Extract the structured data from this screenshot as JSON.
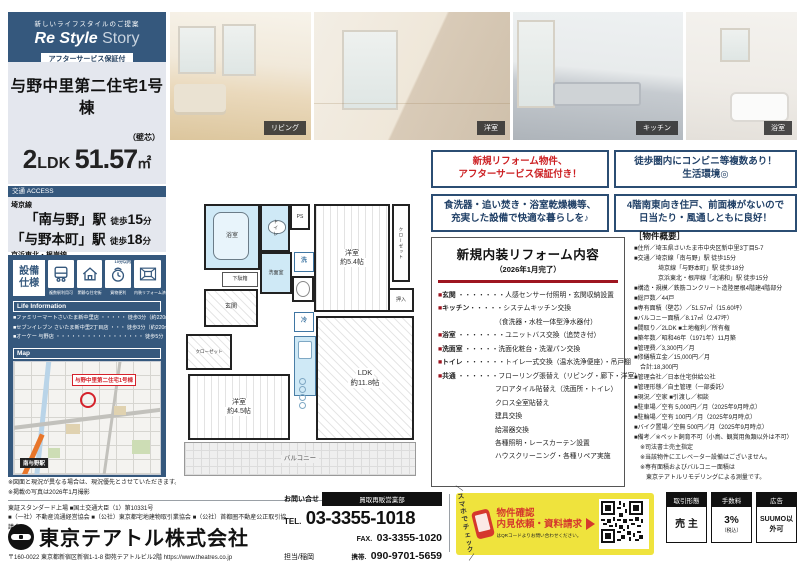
{
  "brand": {
    "tagline": "新しいライフスタイルのご提案",
    "name_bold": "Re Style",
    "name_light": " Story",
    "badge": "アフターサービス保証付"
  },
  "property": {
    "name": "与野中里第二住宅1号棟",
    "layout_num": "2",
    "layout_txt": "LDK",
    "area": "51.57",
    "area_unit": "㎡",
    "area_note": "（壁芯）"
  },
  "access": {
    "header": "交通 ACCESS",
    "groups": [
      {
        "line": "埼京線",
        "stations": [
          {
            "name": "「南与野」駅",
            "walk_pre": "徒歩",
            "walk_num": "15",
            "walk_suf": "分"
          },
          {
            "name": "「与野本町」駅",
            "walk_pre": "徒歩",
            "walk_num": "18",
            "walk_suf": "分"
          }
        ]
      },
      {
        "line": "京浜東北・根岸線",
        "stations": [
          {
            "name": "「北浦和」駅",
            "walk_pre": "徒歩",
            "walk_num": "15",
            "walk_suf": "分"
          }
        ]
      }
    ]
  },
  "features": {
    "title1": "設備",
    "title2": "仕様",
    "tiles": [
      {
        "label": "複数駅利用可"
      },
      {
        "label": "閑静な住宅街"
      },
      {
        "label": "買物便利",
        "note": "10分以内"
      },
      {
        "label": "内装リフォーム済"
      }
    ]
  },
  "life_info": {
    "header": "Life Information",
    "rows": [
      "■ファミリーマートさいたま新中里店 ・・・・・ 徒歩3分（約220m）",
      "■セブンイレブン さいたま新中里2丁目店 ・・・ 徒歩3分（約220m）",
      "■オーケー 与野店 ・・・・・・・・・・・・・・・・・ 徒歩5分（約350m）"
    ]
  },
  "map": {
    "header": "Map",
    "property_label": "与野中里第二住宅1号棟",
    "station_label": "南与野駅"
  },
  "notes": [
    "※図面と現況が異なる場合は、現況優先とさせていただきます。",
    "※掲載の写真は2026年1月撮影"
  ],
  "photos": [
    {
      "label": "リビング"
    },
    {
      "label": "洋室"
    },
    {
      "label": "キッチン"
    },
    {
      "label": "浴室"
    }
  ],
  "highlights": [
    {
      "line1": "新規リフォーム物件、",
      "line2": "アフターサービス保証付き！"
    },
    {
      "line1": "徒歩圏内にコンビニ等複数あり！",
      "line2": "生活環境◎"
    },
    {
      "line1": "食洗器・追い焚き・浴室乾燥機等、",
      "line2": "充実した設備で快適な暮らしを♪"
    },
    {
      "line1": "4階南東向き住戸、前面棟がないので",
      "line2": "日当たり・風通しともに良好！"
    }
  ],
  "reform": {
    "title": "新規内装リフォーム内容",
    "subtitle": "（2026年1月完了）",
    "rows": [
      {
        "bullet": "■",
        "label": "玄関",
        "dots": " ・・・・・・・",
        "text": "人感センサー付照明・玄関収納設置"
      },
      {
        "bullet": "■",
        "label": "キッチン",
        "dots": "・・・・・",
        "text": "システムキッチン交換"
      },
      {
        "text": "（食洗器・水栓一体型浄水器付）"
      },
      {
        "bullet": "■",
        "label": "浴室",
        "dots": " ・・・・・・・",
        "text": "ユニットバス交換（追焚き付）"
      },
      {
        "bullet": "■",
        "label": "洗面室",
        "dots": " ・・・・・",
        "text": "洗面化粧台・洗濯パン交換"
      },
      {
        "bullet": "■",
        "label": "トイレ",
        "dots": " ・・・・・・",
        "text": "トイレ一式交換（温水洗浄便座）・吊戸棚"
      },
      {
        "bullet": "■",
        "label": "共通",
        "dots": " ・・・・・・",
        "text": "フローリング張替え（リビング・廊下・洋室）"
      },
      {
        "text": "フロアタイル貼替え（洗面所・トイレ）"
      },
      {
        "text": "クロス全室貼替え"
      },
      {
        "text": "建具交換"
      },
      {
        "text": "給湯器交換"
      },
      {
        "text": "各種照明・レースカーテン設置"
      },
      {
        "text": "ハウスクリーニング・各種リペア実施"
      }
    ]
  },
  "overview": {
    "header": "［物件概要］",
    "rows": [
      "■住所／埼玉県さいたま市中央区新中里3丁目5-7",
      "■交通／埼京線「南与野」駅 徒歩15分",
      "　　　　埼京線「与野本町」駅 徒歩18分",
      "　　　　京浜東北・根岸線「北浦和」駅 徒歩15分",
      "■構造・規模／鉄筋コンクリート造陸屋根4階建4階部分",
      "■総戸数／44戸",
      "■専有面積（壁芯）／51.57㎡（15.60坪）",
      "■バルコニー面積／8.17㎡（2.47坪）",
      "■間取り／2LDK ■土地権利／所有権",
      "■築年数／昭和46年（1971年）11月築",
      "■管理費／3,300円／月",
      "■修繕積立金／15,000円／月",
      "　合計:18,300円",
      "■管理会社／日本住宅供給公社",
      "■管理形態／自主管理（一部委託）",
      "■現況／空家 ■引渡し／相談",
      "■駐車場／空有 5,000円／月（2025年9月時点）",
      "■駐輪場／空有 100円／月（2025年9月時点）",
      "■バイク置場／空無 500円／月（2025年9月時点）",
      "■備考／※ペット飼育不可（小鳥、観賞用魚類以外は不可）",
      "　※司法書士売主指定",
      "　※当該物件にエレベーター設備はございません。",
      "　※専有面積およびバルコニー面積は",
      "　　東京テアトルリモデリングによる測量です。"
    ]
  },
  "floorplan": {
    "bath": "浴室",
    "toilet": "トイレ",
    "ps": "PS",
    "wash": "洗面室",
    "laundry": "洗",
    "shoe": "下駄箱",
    "entrance": "玄関",
    "closet1": "クローゼット",
    "west1": "洋室",
    "west1_size": "約5.4帖",
    "closet2": "クローゼット",
    "oshiire": "押入",
    "fridge": "冷",
    "ldk": "LDK",
    "ldk_size": "約11.8帖",
    "west2": "洋室",
    "west2_size": "約4.5帖",
    "balcony": "バルコニー"
  },
  "footer": {
    "licenses1": "東証スタンダード上場 ■国土交通大臣（1）第10331号",
    "licenses2": "■（一社）不動産流通経営協会 ■（公社）東京都宅地建物取引業協会 ■（公社）首都圏不動産公正取引協議会",
    "company": "東京テアトル株式会社",
    "address": "〒160-0022 東京都新宿区新宿1-1-8 御苑テアトルビル2階 https://www.theatres.co.jp",
    "contact_label": "お問い合せ",
    "dept": "買取再販営業部",
    "tel_label": "TEL.",
    "tel": "03-3355-1018",
    "fax_label": "FAX.",
    "fax": "03-3355-1020",
    "person": "担当/稲岡",
    "mobile_label": "携帯.",
    "mobile": "090-9701-5659"
  },
  "qr_box": {
    "check": "＼スマホでチェック／",
    "line1": "物件確認",
    "line2": "内見依頼・資料請求",
    "note": "はQRコードよりお問い合わせください。"
  },
  "deal": [
    {
      "label": "取引形態",
      "value": "売 主"
    },
    {
      "label": "手数料",
      "value": "3%",
      "note": "（税込）"
    },
    {
      "label": "広告",
      "value": "SUUMO以外可"
    }
  ],
  "colors": {
    "navy": "#35587d",
    "accent_red": "#9e1520",
    "highlight_red": "#cc1f22",
    "yellow": "#efe33d"
  }
}
